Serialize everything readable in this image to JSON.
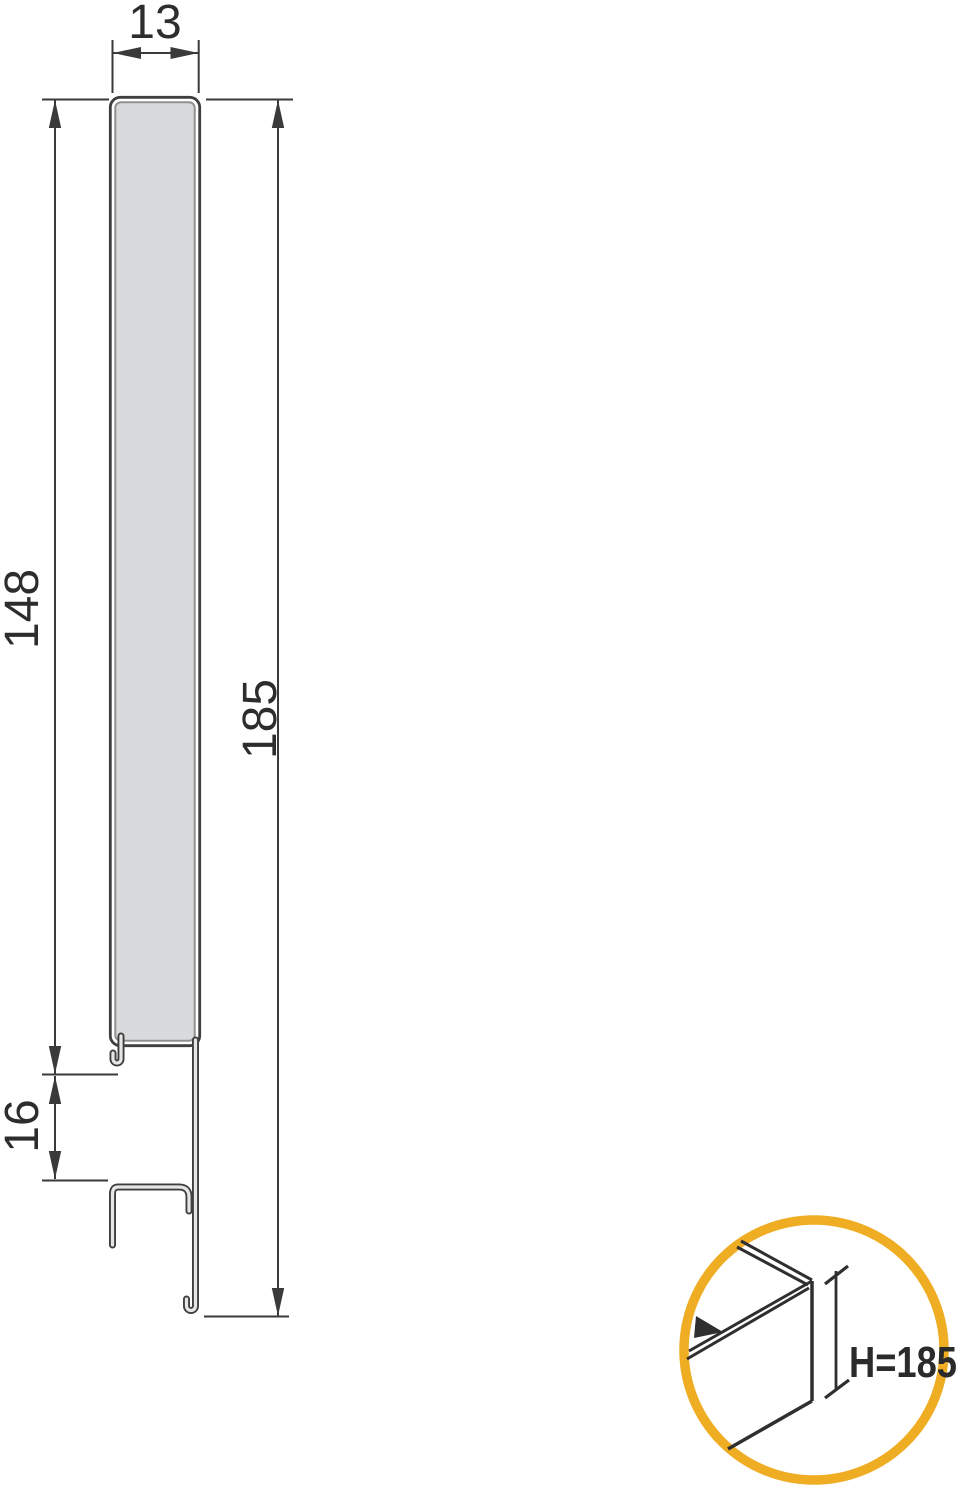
{
  "diagram": {
    "type": "technical-cross-section",
    "subject": "drawer-side-panel-profile",
    "dimensions": {
      "top_width": "13",
      "left_height": "148",
      "left_lower": "16",
      "right_total_height": "185"
    },
    "inset": {
      "label": "H=185"
    },
    "colors": {
      "line": "#3a3a3a",
      "panel_fill": "#d9dadb",
      "sheet_core": "#e6e6e6",
      "accent_circle": "#efad24",
      "label_text": "#2d2d2d"
    }
  }
}
